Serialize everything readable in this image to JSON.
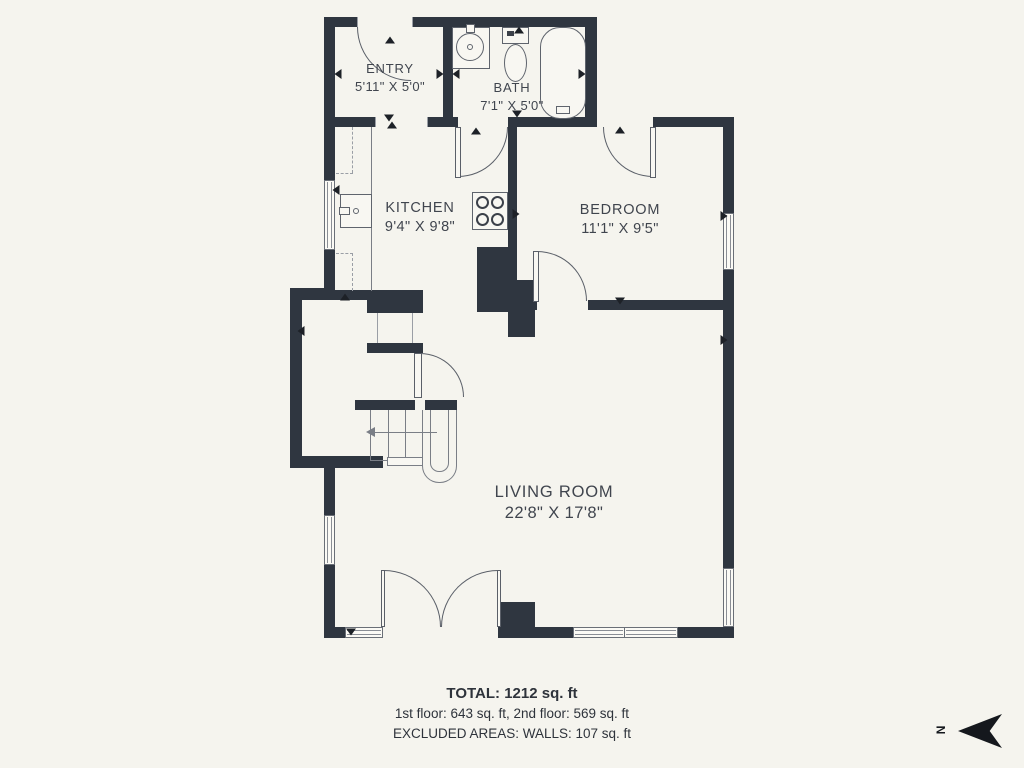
{
  "colors": {
    "wall": "#2f3640",
    "background": "#f5f4ee",
    "fixture_line": "#5a5f68",
    "label_text": "#40454e",
    "marker": "#1d2127"
  },
  "rooms": [
    {
      "name": "ENTRY",
      "dimensions": "5'11\" X 5'0\""
    },
    {
      "name": "BATH",
      "dimensions": "7'1\" X 5'0\""
    },
    {
      "name": "KITCHEN",
      "dimensions": "9'4\" X 9'8\""
    },
    {
      "name": "BEDROOM",
      "dimensions": "11'1\" X 9'5\""
    },
    {
      "name": "LIVING ROOM",
      "dimensions": "22'8\" X 17'8\""
    }
  ],
  "summary": {
    "total": "TOTAL: 1212 sq. ft",
    "floors": "1st floor: 643 sq. ft, 2nd floor: 569 sq. ft",
    "excluded": "EXCLUDED AREAS: WALLS: 107 sq. ft"
  },
  "compass": {
    "label": "N",
    "direction": "left"
  },
  "markers": [
    {
      "x": 390,
      "y": 40,
      "dir": "up"
    },
    {
      "x": 338,
      "y": 74,
      "dir": "left"
    },
    {
      "x": 440,
      "y": 74,
      "dir": "right"
    },
    {
      "x": 456,
      "y": 74,
      "dir": "left"
    },
    {
      "x": 389,
      "y": 118,
      "dir": "down"
    },
    {
      "x": 392,
      "y": 125,
      "dir": "up"
    },
    {
      "x": 519,
      "y": 30,
      "dir": "up"
    },
    {
      "x": 517,
      "y": 114,
      "dir": "down"
    },
    {
      "x": 582,
      "y": 74,
      "dir": "right"
    },
    {
      "x": 476,
      "y": 131,
      "dir": "up"
    },
    {
      "x": 336,
      "y": 190,
      "dir": "left"
    },
    {
      "x": 516,
      "y": 214,
      "dir": "right"
    },
    {
      "x": 620,
      "y": 130,
      "dir": "up"
    },
    {
      "x": 724,
      "y": 216,
      "dir": "right"
    },
    {
      "x": 620,
      "y": 301,
      "dir": "down"
    },
    {
      "x": 301,
      "y": 331,
      "dir": "left"
    },
    {
      "x": 345,
      "y": 297,
      "dir": "up"
    },
    {
      "x": 724,
      "y": 340,
      "dir": "right"
    },
    {
      "x": 351,
      "y": 632,
      "dir": "down"
    }
  ]
}
